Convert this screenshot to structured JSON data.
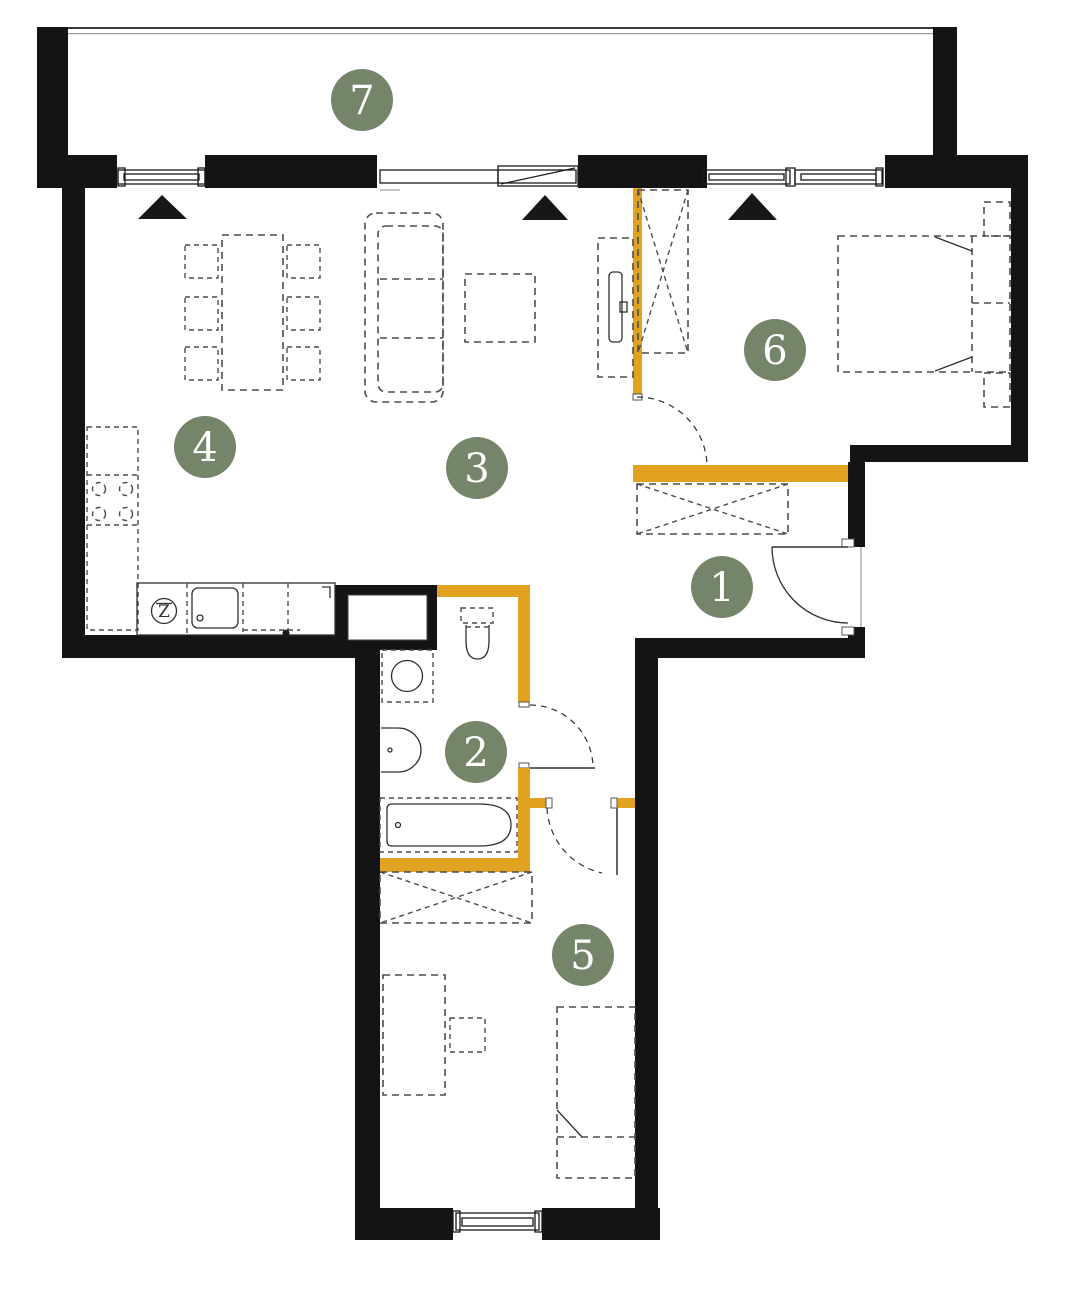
{
  "canvas": {
    "width": 1072,
    "height": 1296
  },
  "colors": {
    "wall": "#141414",
    "accent_wall": "#E0A220",
    "badge": "#75856A",
    "furniture_line": "#4d4d4d",
    "background": "#ffffff"
  },
  "badges": [
    {
      "number": "1"
    },
    {
      "number": "2"
    },
    {
      "number": "3"
    },
    {
      "number": "4"
    },
    {
      "number": "5"
    },
    {
      "number": "6"
    },
    {
      "number": "7"
    }
  ],
  "kitchen": {
    "sink_symbol": "Z"
  }
}
